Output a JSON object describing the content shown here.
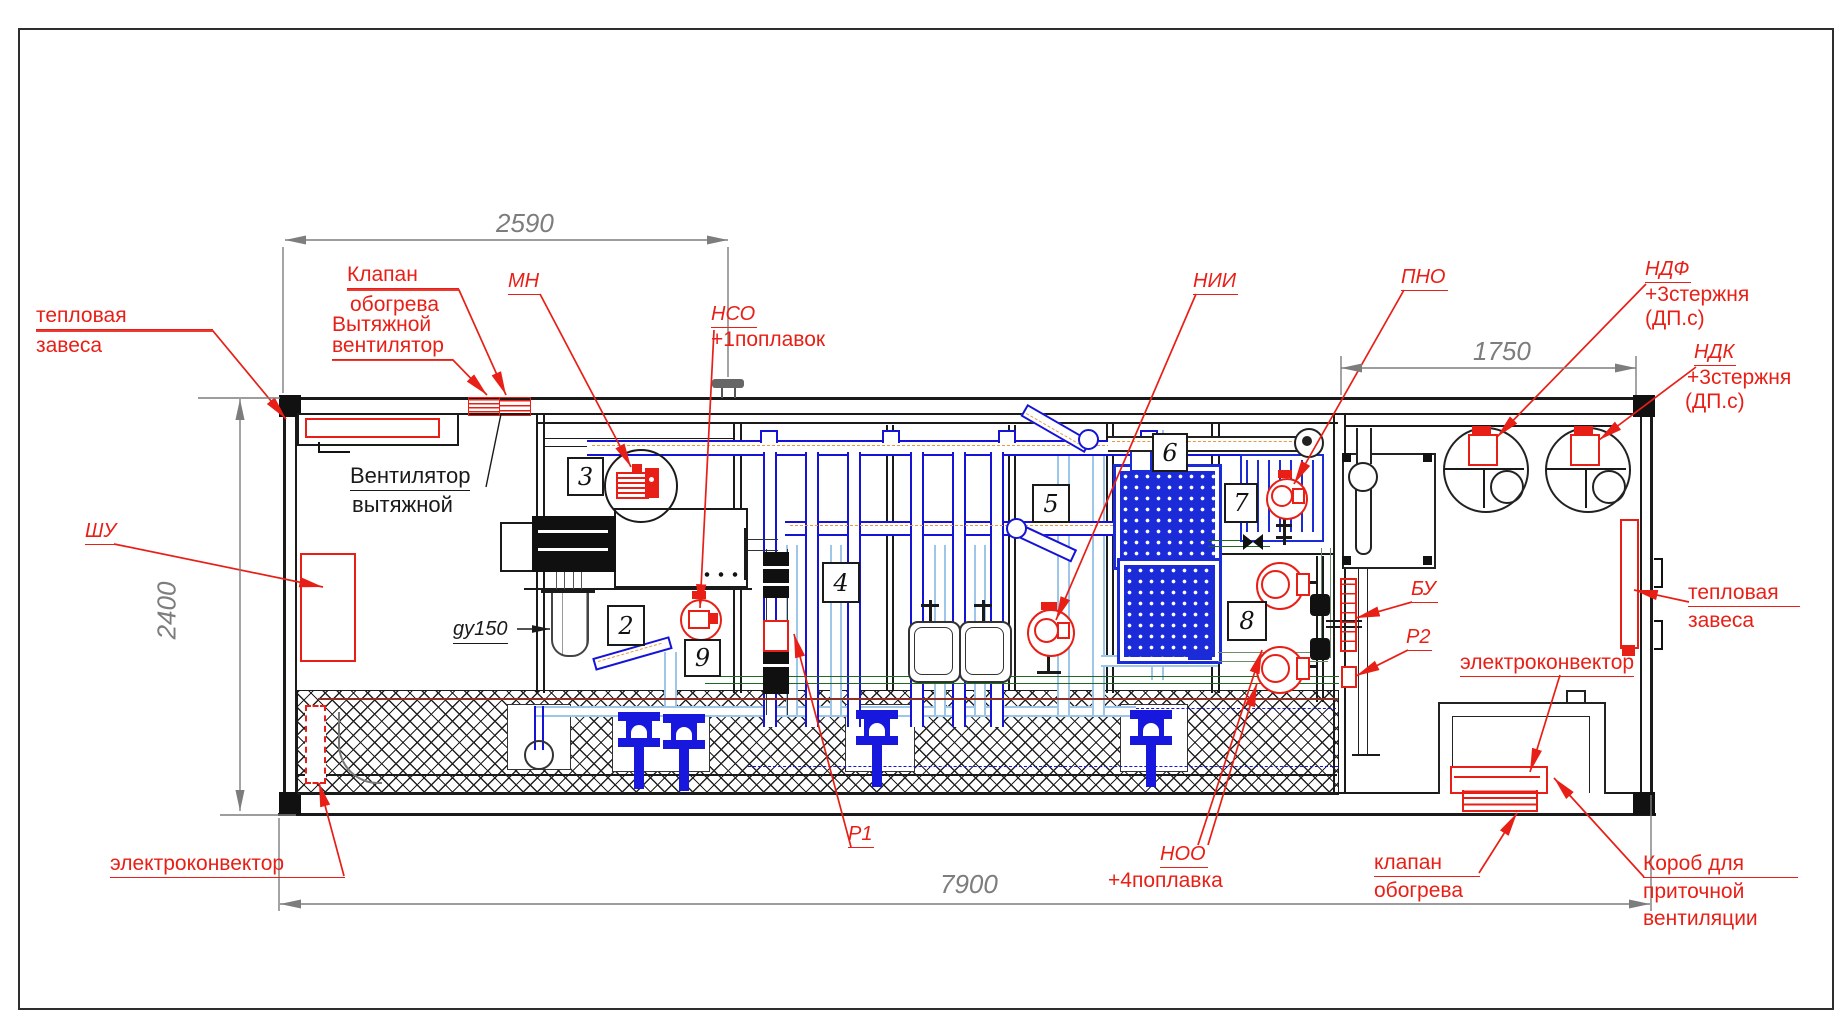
{
  "dims": {
    "top": "2590",
    "right_top": "1750",
    "left": "2400",
    "bottom": "7900"
  },
  "labels": {
    "tc_left_l1": "тепловая",
    "tc_left_l2": "завеса",
    "valve_roof_l1": "Клапан",
    "valve_roof_l2": "обогрева",
    "fan_red_l1": "Вытяжной",
    "fan_red_l2": "вентилятор",
    "fan_black_l1": "Вентилятор",
    "fan_black_l2": "вытяжной",
    "shu": "ШУ",
    "mn": "МН",
    "nso": "НСО",
    "nso_note": "+1поплавок",
    "nii": "НИИ",
    "pno": "ПНО",
    "ndf": "НДФ",
    "ndf_n1": "+3стержня",
    "ndf_n2": "(ДП.с)",
    "ndk": "НДК",
    "ndk_n1": "+3стержня",
    "ndk_n2": "(ДП.с)",
    "bu": "БУ",
    "p1": "Р1",
    "p2": "Р2",
    "noo": "НОО",
    "noo_note": "+4поплавка",
    "tc_right_l1": "тепловая",
    "tc_right_l2": "завеса",
    "conv_right": "электроконвектор",
    "conv_left": "электроконвектор",
    "valve_bottom_l1": "клапан",
    "valve_bottom_l2": "обогрева",
    "duct_l1": "Короб для",
    "duct_l2": "приточной",
    "duct_l3": "вентиляции",
    "gy150": "gy150"
  },
  "positions": {
    "n2": "2",
    "n3": "3",
    "n4": "4",
    "n5": "5",
    "n6": "6",
    "n7": "7",
    "n8": "8",
    "n9": "9"
  },
  "colors": {
    "annotation_red": "#e81f16",
    "pipe_blue": "#1413d6",
    "pipe_light_blue": "#9dc6e8",
    "membrane_blue": "#1c2bd8",
    "air_orange": "#e8993d",
    "drain_green": "#1d691d",
    "dim_gray": "#7d7d7d",
    "line_black": "#1a1a1a",
    "floor_pump_blue": "#1717dd"
  }
}
